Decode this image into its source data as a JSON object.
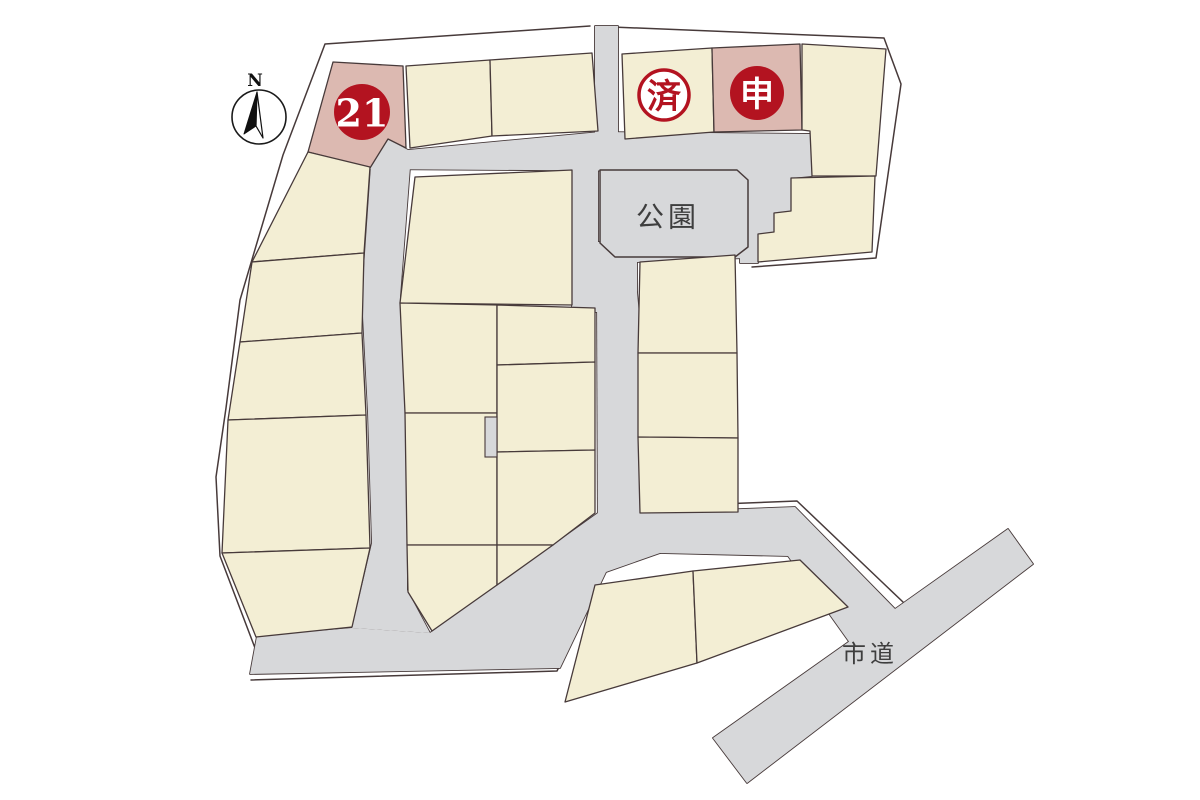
{
  "labels": {
    "north": "N",
    "lot21": "21",
    "sold": "済",
    "applied": "申",
    "park": "公園",
    "city_road": "市道"
  },
  "colors": {
    "lot": "#f3eed4",
    "highlight": "#dcb9b1",
    "road": "#d7d8da",
    "red": "#b31320",
    "outline": "#473a3a",
    "label": "#3e3e3e"
  }
}
